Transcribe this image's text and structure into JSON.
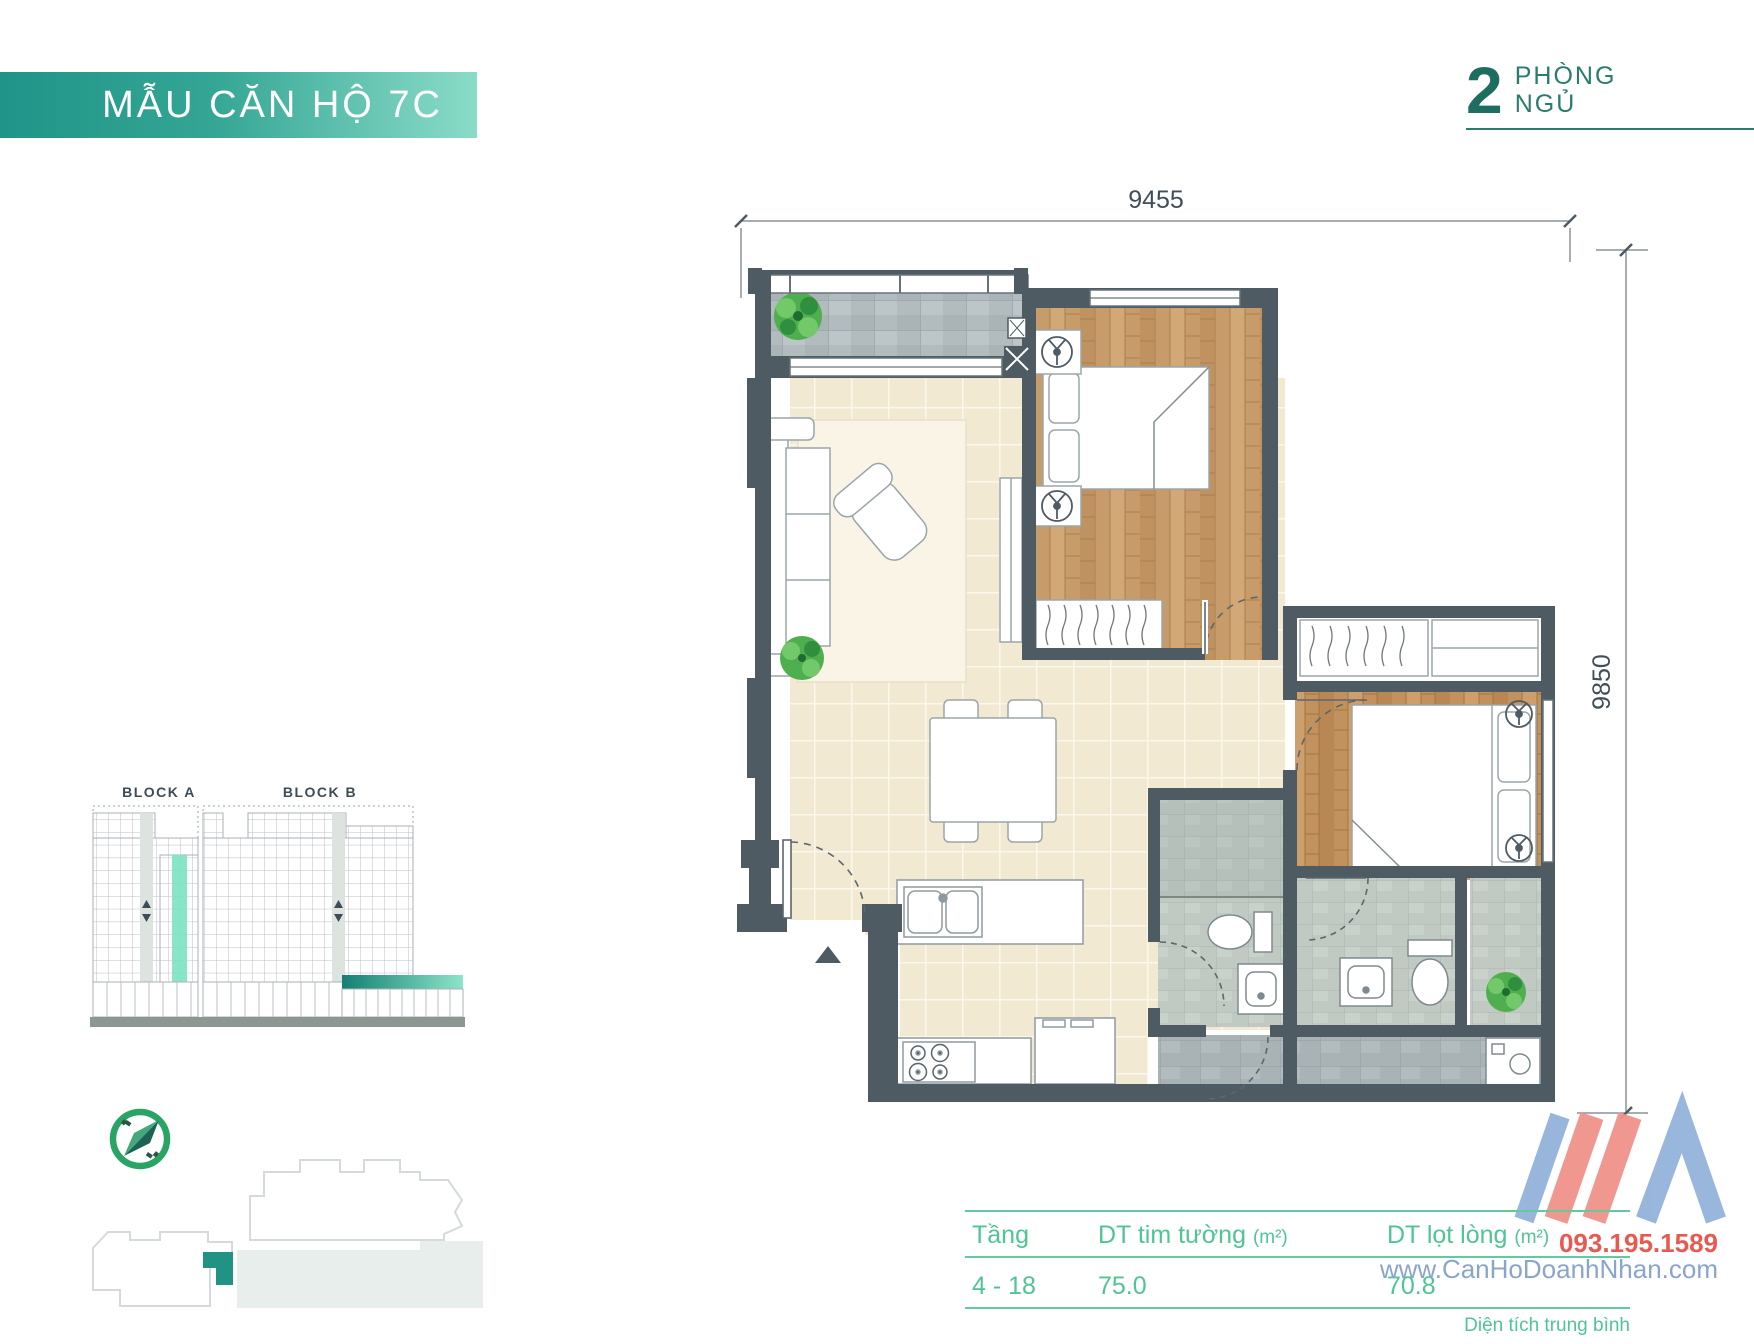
{
  "header": {
    "title": "MẪU CĂN HỘ 7C",
    "bedrooms_number": "2",
    "bedrooms_word1": "PHÒNG",
    "bedrooms_word2": "NGỦ"
  },
  "floor_plan": {
    "dim_width_mm": "9455",
    "dim_height_mm": "9850"
  },
  "blocks": {
    "block_a_label": "BLOCK A",
    "block_b_label": "BLOCK B"
  },
  "table": {
    "columns": [
      {
        "label": "Tầng",
        "unit": ""
      },
      {
        "label": "DT tim tường",
        "unit": "(m²)"
      },
      {
        "label": "DT lọt lòng",
        "unit": "(m²)"
      }
    ],
    "row": {
      "floors": "4 - 18",
      "gross_area": "75.0",
      "net_area": "70.8"
    },
    "footnote": "Diện tích trung bình"
  },
  "watermark": {
    "phone": "093.195.1589",
    "website": "www.CanHoDoanhNhan.com"
  },
  "colors": {
    "banner_gradient_start": "#1f9488",
    "banner_gradient_end": "#8adcc8",
    "accent_dark_teal": "#1e6e60",
    "table_green": "#4fc593",
    "wall_gray": "#4e5b63",
    "highlight_mint": "#7ee3c2",
    "watermark_red": "#e85a50",
    "watermark_blue": "#8aa5cd"
  }
}
